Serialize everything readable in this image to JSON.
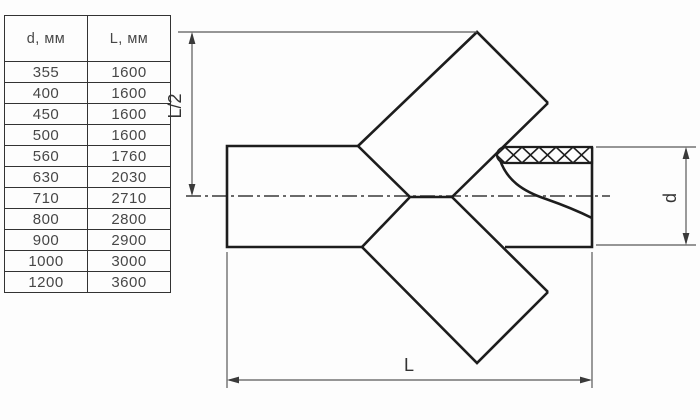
{
  "table": {
    "headers": [
      "d, мм",
      "L, мм"
    ],
    "rows": [
      [
        "355",
        "1600"
      ],
      [
        "400",
        "1600"
      ],
      [
        "450",
        "1600"
      ],
      [
        "500",
        "1600"
      ],
      [
        "560",
        "1760"
      ],
      [
        "630",
        "2030"
      ],
      [
        "710",
        "2710"
      ],
      [
        "800",
        "2800"
      ],
      [
        "900",
        "2900"
      ],
      [
        "1000",
        "3000"
      ],
      [
        "1200",
        "3600"
      ]
    ]
  },
  "diagram": {
    "labels": {
      "half_length": "L/2",
      "diameter": "d",
      "length": "L"
    }
  },
  "colors": {
    "outline": "#1d1d1d",
    "thin_line": "#595959",
    "axis_line": "#3a3a3a",
    "text": "#474747",
    "table_border": "#333333",
    "background": "#fdfdfd"
  }
}
